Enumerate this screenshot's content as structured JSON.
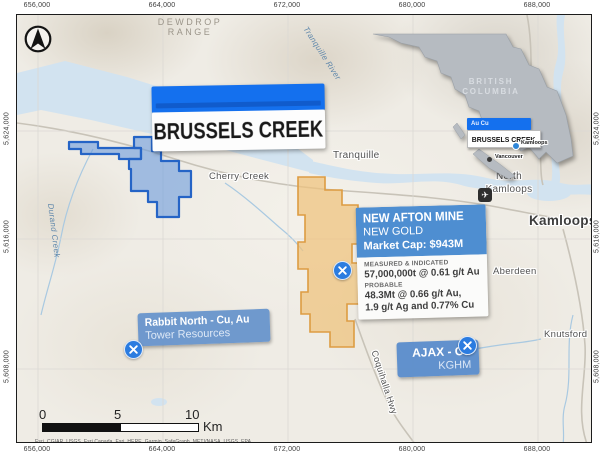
{
  "axis": {
    "top": [
      "656,000",
      "664,000",
      "672,000",
      "680,000",
      "688,000"
    ],
    "bottom": [
      "656,000",
      "664,000",
      "672,000",
      "680,000",
      "688,000"
    ],
    "left": [
      "5,624,000",
      "5,616,000",
      "5,608,000"
    ],
    "right": [
      "5,624,000",
      "5,616,000",
      "5,608,000"
    ]
  },
  "title_label": {
    "text": "BRUSSELS CREEK"
  },
  "map_labels": {
    "dewdrop_range": "DEWDROP RANGE",
    "tranquille_river": "Tranquille River",
    "cherry_creek": "Cherry Creek",
    "durand_creek": "Durand Creek",
    "tranquille": "Tranquille",
    "north_kamloops": "North Kamloops",
    "kamloops": "Kamloops",
    "aberdeen": "Aberdeen",
    "knutsford": "Knutsford",
    "coquihalla_hwy": "Coquihalla Hwy"
  },
  "inset": {
    "region": "BRITISH COLUMBIA",
    "tag": "Au Cu",
    "label": "BRUSSELS CREEK",
    "city_kamloops": "Kamloops",
    "city_vancouver": "Vancouver"
  },
  "new_afton": {
    "title": "NEW AFTON MINE",
    "company": "NEW GOLD",
    "market_cap": "Market Cap: $943M",
    "mi_heading": "MEASURED & INDICATED",
    "mi_value": "57,000,000t @ 0.61 g/t Au",
    "prob_heading": "PROBABLE",
    "prob_value1": "48.3Mt @ 0.66 g/t Au,",
    "prob_value2": "1.9 g/t Ag and 0.77% Cu"
  },
  "rabbit_north": {
    "title": "Rabbit North - Cu, Au",
    "company": "Tower Resources"
  },
  "ajax": {
    "title": "AJAX - Cu",
    "company": "KGHM"
  },
  "scale_bar": {
    "t0": "0",
    "t5": "5",
    "t10": "10",
    "unit": "Km"
  },
  "attribution_line1": "Esri, CGIAR, USGS, Esri Canada, Esri, HERE, Garmin, SafeGraph, METI/NASA, USGS, EPA,",
  "attribution_line2": "USDA, NRCan, Parks Canada",
  "colors": {
    "accent_blue": "#1470ee",
    "label_box_blue": "#4e8ed1",
    "claim_fill": "#6b9bdc",
    "claim_border": "#2564c6",
    "property_fill": "#eec27c",
    "property_border": "#dd9c42",
    "water": "#d2e3f0",
    "inset_gray": "#b6bbc1"
  }
}
